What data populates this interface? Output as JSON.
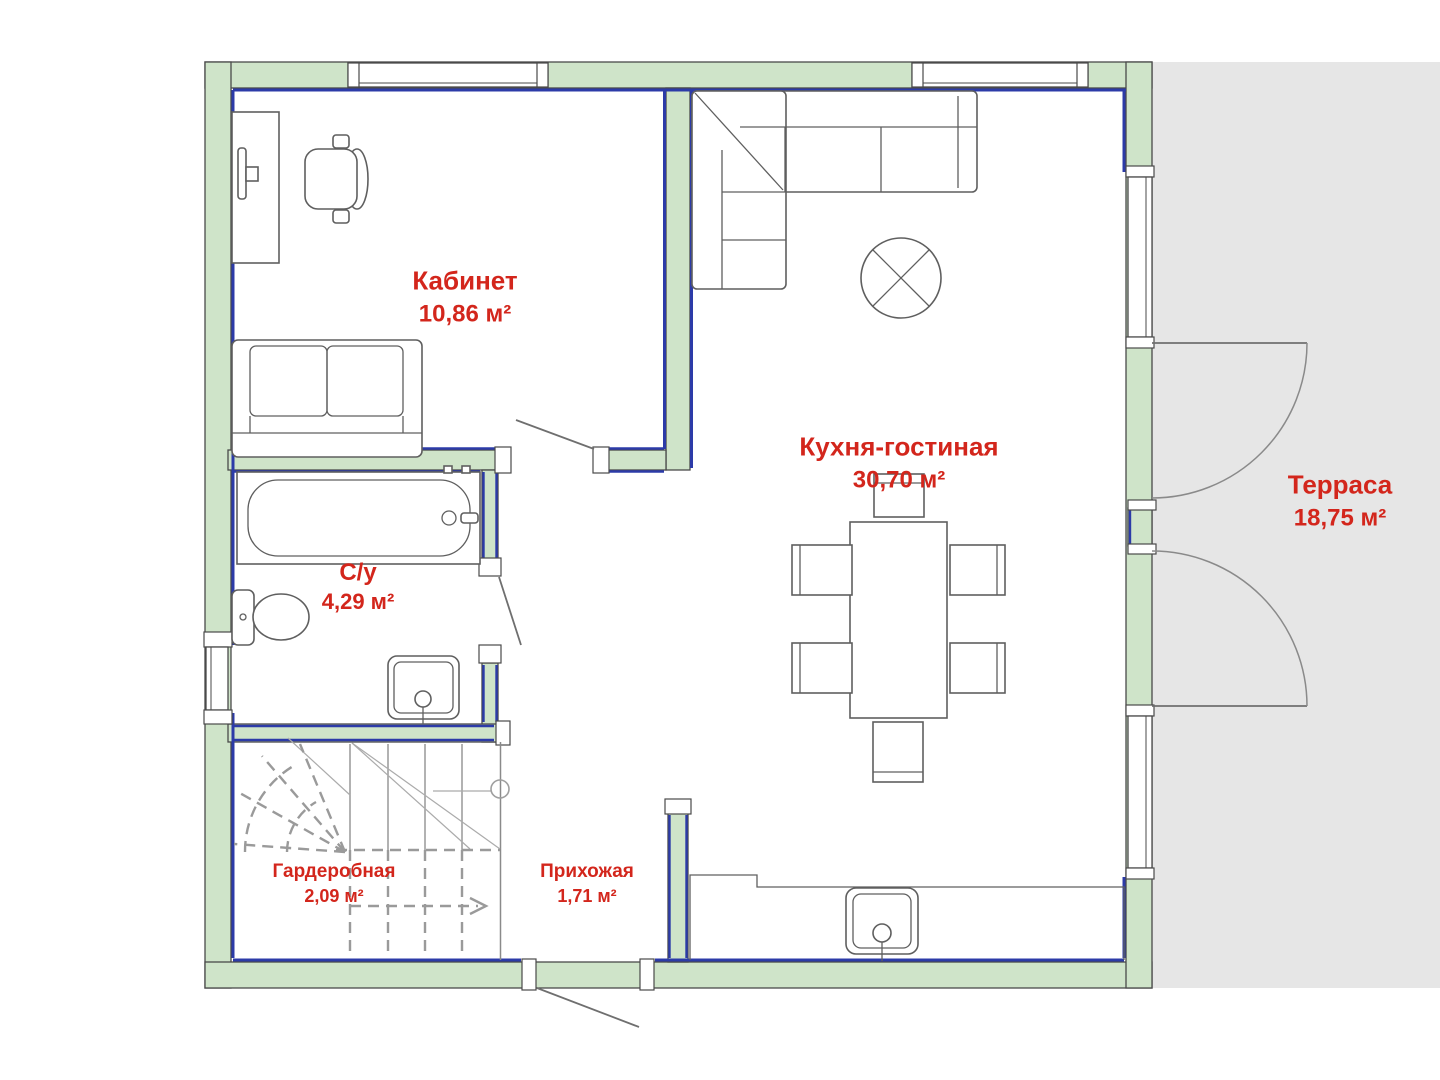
{
  "rooms": {
    "office": {
      "name": "Кабинет",
      "area": "10,86 м²"
    },
    "kitchen_living": {
      "name": "Кухня-гостиная",
      "area": "30,70 м²"
    },
    "bathroom": {
      "name": "С/у",
      "area": "4,29 м²"
    },
    "wardrobe": {
      "name": "Гардеробная",
      "area": "2,09 м²"
    },
    "hallway": {
      "name": "Прихожая",
      "area": "1,71 м²"
    },
    "terrace": {
      "name": "Терраса",
      "area": "18,75 м²"
    }
  },
  "colors": {
    "wall_fill": "#cfe4c9",
    "accent_blue": "#2c3ba8",
    "outline": "#4a4a4a",
    "furniture_line": "#5f5f5f",
    "terrace_fill": "#e6e6e6",
    "label_red": "#d3261c",
    "stair_line": "#9a9a9a"
  }
}
